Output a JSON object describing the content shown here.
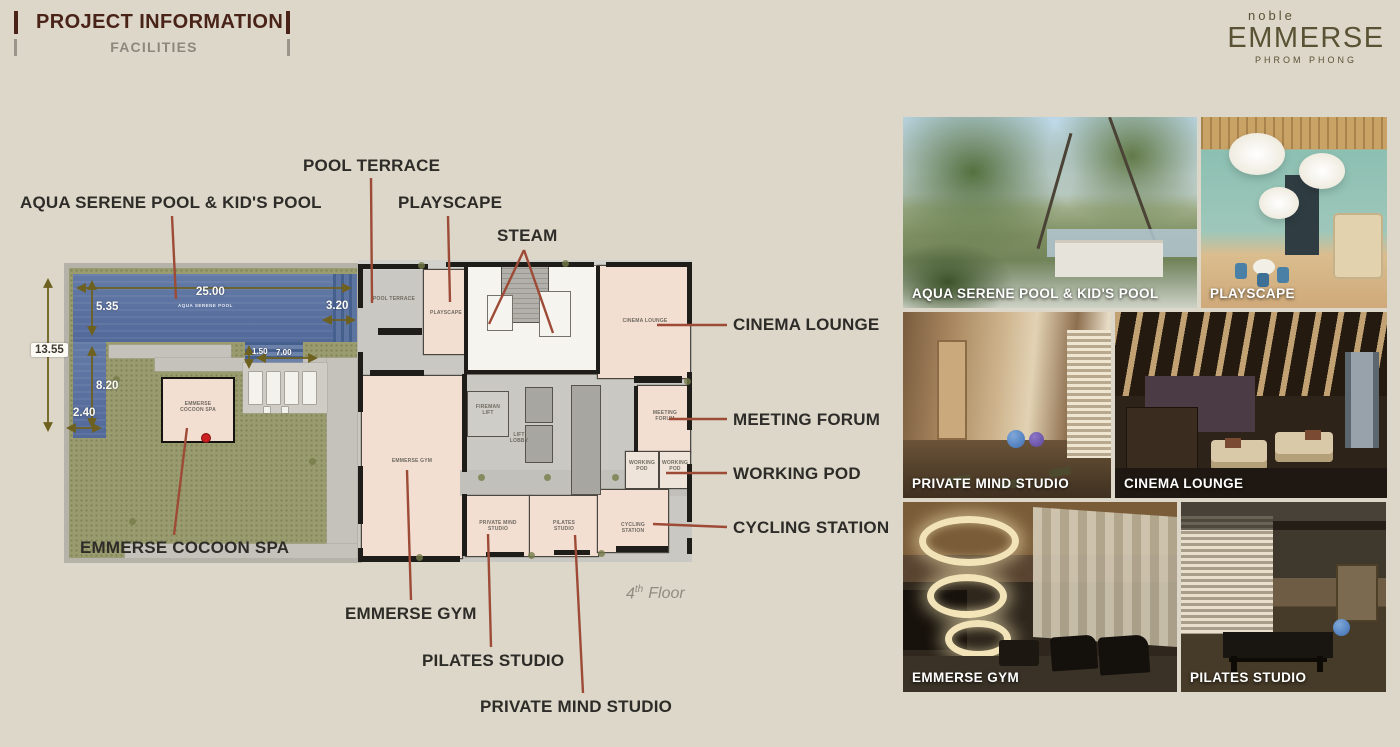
{
  "header": {
    "title": "PROJECT INFORMATION",
    "subtitle": "FACILITIES"
  },
  "logo": {
    "pre": "noble",
    "name": "EMMERSE",
    "sub": "PHROM PHONG"
  },
  "floor_tag": {
    "number": "4",
    "suffix": "th",
    "label": "Floor"
  },
  "callouts": {
    "pool_terrace": "POOL TERRACE",
    "aqua_pool": "AQUA SERENE POOL & KID'S POOL",
    "playscape": "PLAYSCAPE",
    "steam": "STEAM",
    "cinema_lounge": "CINEMA LOUNGE",
    "meeting_forum": "MEETING FORUM",
    "working_pod": "WORKING POD",
    "cycling_station": "CYCLING STATION",
    "cocoon_spa": "EMMERSE COCOON SPA",
    "emmerse_gym": "EMMERSE GYM",
    "pilates_studio": "PILATES STUDIO",
    "private_mind_studio": "PRIVATE MIND STUDIO"
  },
  "plan": {
    "dimensions": {
      "pool_length": "25.00",
      "pool_width": "5.35",
      "pool_end": "3.20",
      "site_depth": "13.55",
      "pool_arm": "8.20",
      "pool_arm_width": "2.40",
      "deck_width": "1.50",
      "deck_length": "7.00"
    },
    "rooms": {
      "aqua_pool": "AQUA SERENE POOL",
      "cocoon_spa_l1": "EMMERSE",
      "cocoon_spa_l2": "COCOON SPA",
      "pool_terrace": "POOL TERRACE",
      "playscape": "PLAYSCAPE",
      "cinema_lounge": "CINEMA LOUNGE",
      "fireman_lift_l1": "FIREMAN",
      "fireman_lift_l2": "LIFT",
      "lift_lobby_l1": "LIFT",
      "lift_lobby_l2": "LOBBY",
      "emmerse_gym": "EMMERSE GYM",
      "meeting_forum_l1": "MEETING",
      "meeting_forum_l2": "FORUM",
      "working_pod_1_l1": "WORKING",
      "working_pod_1_l2": "POD",
      "working_pod_2_l1": "WORKING",
      "working_pod_2_l2": "POD",
      "private_mind_l1": "PRIVATE MIND",
      "private_mind_l2": "STUDIO",
      "pilates_l1": "PILATES",
      "pilates_l2": "STUDIO",
      "cycling_l1": "CYCLING",
      "cycling_l2": "STATION"
    }
  },
  "gallery": [
    {
      "caption": "AQUA SERENE POOL & KID'S POOL"
    },
    {
      "caption": "PLAYSCAPE"
    },
    {
      "caption": "PRIVATE MIND STUDIO"
    },
    {
      "caption": "CINEMA LOUNGE"
    },
    {
      "caption": "EMMERSE GYM"
    },
    {
      "caption": "PILATES STUDIO"
    }
  ],
  "colors": {
    "accent_maroon": "#4a2318",
    "logo_olive": "#5a5234",
    "leader_red": "#9d4b37",
    "dim_olive": "#6e601e",
    "pool_blue": "#5d74a1",
    "grass_green": "#9a9c6f"
  }
}
